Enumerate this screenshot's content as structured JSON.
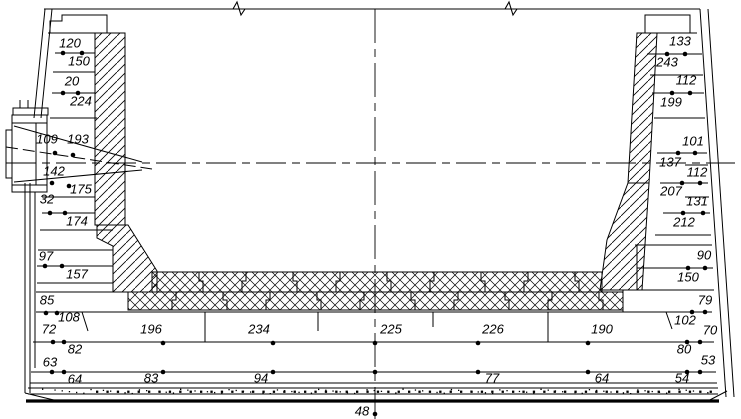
{
  "drawing": {
    "description": "Cross-section of metallurgical vessel refractory lining with residual thickness measurement points",
    "background_color": "#ffffff",
    "line_color": "#000000",
    "measurements": {
      "left_wall": [
        {
          "value": "120",
          "x": 70,
          "y": 44
        },
        {
          "value": "150",
          "x": 79,
          "y": 62
        },
        {
          "value": "20",
          "x": 72,
          "y": 82
        },
        {
          "value": "224",
          "x": 81,
          "y": 102
        },
        {
          "value": "109",
          "x": 47,
          "y": 140
        },
        {
          "value": "193",
          "x": 78,
          "y": 140
        },
        {
          "value": "142",
          "x": 54,
          "y": 172
        },
        {
          "value": "175",
          "x": 81,
          "y": 190
        },
        {
          "value": "32",
          "x": 47,
          "y": 200
        },
        {
          "value": "174",
          "x": 77,
          "y": 222
        },
        {
          "value": "97",
          "x": 46,
          "y": 257
        },
        {
          "value": "157",
          "x": 77,
          "y": 275
        },
        {
          "value": "85",
          "x": 47,
          "y": 301
        },
        {
          "value": "108",
          "x": 69,
          "y": 318
        },
        {
          "value": "72",
          "x": 49,
          "y": 330
        },
        {
          "value": "82",
          "x": 75,
          "y": 350
        },
        {
          "value": "63",
          "x": 50,
          "y": 363
        },
        {
          "value": "64",
          "x": 75,
          "y": 380
        }
      ],
      "bottom": [
        {
          "value": "196",
          "x": 151,
          "y": 330
        },
        {
          "value": "234",
          "x": 259,
          "y": 330
        },
        {
          "value": "225",
          "x": 391,
          "y": 330
        },
        {
          "value": "226",
          "x": 493,
          "y": 330
        },
        {
          "value": "190",
          "x": 602,
          "y": 330
        },
        {
          "value": "83",
          "x": 151,
          "y": 379
        },
        {
          "value": "94",
          "x": 261,
          "y": 379
        },
        {
          "value": "77",
          "x": 492,
          "y": 379
        },
        {
          "value": "64",
          "x": 602,
          "y": 379
        },
        {
          "value": "48",
          "x": 362,
          "y": 412
        }
      ],
      "right_wall": [
        {
          "value": "133",
          "x": 680,
          "y": 42
        },
        {
          "value": "243",
          "x": 667,
          "y": 63
        },
        {
          "value": "112",
          "x": 686,
          "y": 81
        },
        {
          "value": "199",
          "x": 671,
          "y": 103
        },
        {
          "value": "101",
          "x": 693,
          "y": 142
        },
        {
          "value": "137",
          "x": 670,
          "y": 163
        },
        {
          "value": "112",
          "x": 697,
          "y": 173
        },
        {
          "value": "207",
          "x": 671,
          "y": 192
        },
        {
          "value": "131",
          "x": 697,
          "y": 202
        },
        {
          "value": "212",
          "x": 684,
          "y": 223
        },
        {
          "value": "90",
          "x": 704,
          "y": 256
        },
        {
          "value": "150",
          "x": 688,
          "y": 278
        },
        {
          "value": "79",
          "x": 705,
          "y": 301
        },
        {
          "value": "102",
          "x": 685,
          "y": 321
        },
        {
          "value": "70",
          "x": 710,
          "y": 331
        },
        {
          "value": "80",
          "x": 684,
          "y": 350
        },
        {
          "value": "53",
          "x": 708,
          "y": 361
        },
        {
          "value": "54",
          "x": 682,
          "y": 379
        }
      ]
    },
    "points": [
      {
        "x": 63,
        "y": 53
      },
      {
        "x": 82,
        "y": 53
      },
      {
        "x": 63,
        "y": 93
      },
      {
        "x": 78,
        "y": 93
      },
      {
        "x": 55,
        "y": 153
      },
      {
        "x": 73,
        "y": 155
      },
      {
        "x": 52,
        "y": 183
      },
      {
        "x": 69,
        "y": 186
      },
      {
        "x": 50,
        "y": 213
      },
      {
        "x": 65,
        "y": 213
      },
      {
        "x": 45,
        "y": 266
      },
      {
        "x": 62,
        "y": 266
      },
      {
        "x": 46,
        "y": 313
      },
      {
        "x": 57,
        "y": 313
      },
      {
        "x": 53,
        "y": 342
      },
      {
        "x": 64,
        "y": 342
      },
      {
        "x": 52,
        "y": 372
      },
      {
        "x": 64,
        "y": 372
      },
      {
        "x": 163,
        "y": 343
      },
      {
        "x": 273,
        "y": 343
      },
      {
        "x": 375,
        "y": 343
      },
      {
        "x": 478,
        "y": 343
      },
      {
        "x": 588,
        "y": 343
      },
      {
        "x": 163,
        "y": 372
      },
      {
        "x": 273,
        "y": 372
      },
      {
        "x": 375,
        "y": 372
      },
      {
        "x": 478,
        "y": 372
      },
      {
        "x": 588,
        "y": 372
      },
      {
        "x": 375,
        "y": 414
      },
      {
        "x": 667,
        "y": 54
      },
      {
        "x": 685,
        "y": 54
      },
      {
        "x": 672,
        "y": 93
      },
      {
        "x": 690,
        "y": 93
      },
      {
        "x": 678,
        "y": 153
      },
      {
        "x": 695,
        "y": 153
      },
      {
        "x": 682,
        "y": 183
      },
      {
        "x": 700,
        "y": 183
      },
      {
        "x": 683,
        "y": 213
      },
      {
        "x": 703,
        "y": 213
      },
      {
        "x": 688,
        "y": 268
      },
      {
        "x": 705,
        "y": 268
      },
      {
        "x": 692,
        "y": 312
      },
      {
        "x": 705,
        "y": 312
      },
      {
        "x": 687,
        "y": 342
      },
      {
        "x": 700,
        "y": 342
      },
      {
        "x": 687,
        "y": 372
      },
      {
        "x": 700,
        "y": 372
      }
    ]
  }
}
